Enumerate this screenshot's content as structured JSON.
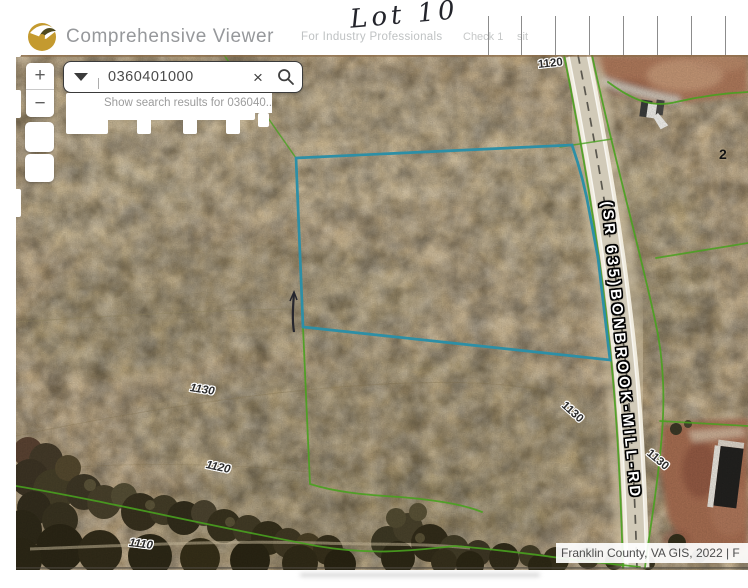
{
  "header": {
    "app_title": "Comprehensive Viewer",
    "tagline": "For Industry Professionals",
    "handwritten_note": "Lot 10",
    "faint_note_left": "Check 1",
    "faint_note_right": "sit"
  },
  "search": {
    "value": "0360401000",
    "suggestion": "Show search results for 036040...",
    "clear_glyph": "×"
  },
  "zoom_controls": {
    "zoom_in": "+",
    "zoom_out": "−"
  },
  "map": {
    "road_label": "(SR 635)BONBROOK-MILL-RD",
    "partial_parcel_label": "2",
    "contour_labels": [
      {
        "text": "1120"
      },
      {
        "text": "1130"
      },
      {
        "text": "1120"
      },
      {
        "text": "1130"
      },
      {
        "text": "1130"
      },
      {
        "text": "1110"
      }
    ],
    "attribution": "Franklin County, VA GIS, 2022 | F"
  },
  "colors": {
    "selected_parcel_outline": "#2d8fa6",
    "parcel_line_green": "#49a11f",
    "logo_gold": "#c49a2f",
    "terrain_tan": "#c6ae86"
  }
}
